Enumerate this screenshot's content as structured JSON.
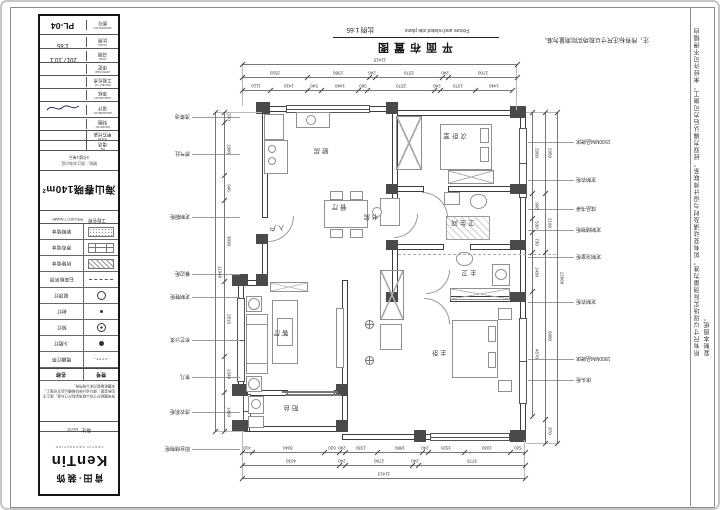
{
  "sheet": {
    "top_note": "注，所有标注尺寸以现场实际测量为准。",
    "edge_note": "所有尺寸以现场实际测量为准，如有变动请及时与设计师联系，经双方确认后方可施工。未经许可不得擅自复制本图纸。",
    "title": {
      "zh": "平面布置图",
      "en": "Fixture and related site plans",
      "scale": "比例 1:65"
    }
  },
  "title_block": {
    "fields": [
      {
        "value": "PL-04",
        "zh": "图号",
        "en": "DRAWING NO"
      },
      {
        "value": "1:65",
        "zh": "比例",
        "en": "SCALE"
      },
      {
        "value": "2017.10.1",
        "zh": "日期",
        "en": "DATE"
      },
      {
        "value": "",
        "zh": "审定",
        "en": "APPROVED"
      },
      {
        "value": "",
        "zh": "工程负责",
        "en": "PROJECT M."
      },
      {
        "value": "",
        "zh": "审核",
        "en": "CHECKED BY"
      },
      {
        "value": "sig",
        "zh": "设计",
        "en": "DESIGNED BY"
      },
      {
        "value": "",
        "zh": "制图",
        "en": "DRAWN BY"
      },
      {
        "value": "",
        "zh": "甲方代表",
        "en": "CLIENT"
      },
      {
        "value": "",
        "zh": "电话",
        "en": "TEL"
      }
    ],
    "address_lines": [
      "地址：剑江半岛小区",
      "3号楼1单元"
    ],
    "project": {
      "value": "海山春晓140m²",
      "zh": "工程名称",
      "en": "PROJECT NAME"
    },
    "legend": {
      "name_header": "名称",
      "symbol_header": "符号",
      "rows": [
        {
          "name": "新砌墙体",
          "sym": "dotted"
        },
        {
          "name": "原有墙体",
          "sym": "brick"
        },
        {
          "name": "拆除墙体",
          "sym": "hatch"
        },
        {
          "name": "石膏板吊顶",
          "sym": "dashed"
        },
        {
          "name": "吸顶灯",
          "sym": "ring"
        },
        {
          "name": "射灯",
          "sym": "dot"
        },
        {
          "name": "筒灯",
          "sym": "target"
        },
        {
          "name": "斗胆灯",
          "sym": "disc"
        },
        {
          "name": "暗藏灯带",
          "sym": "strip"
        }
      ]
    },
    "note": {
      "zh": "备注",
      "en": "NOTE",
      "text": "所有图纸尺寸均以现场实际尺寸为准，施工中如有变更，请与设计师协商确认后方可施工，本图纸版权归本公司所有。"
    },
    "brand": {
      "logo": "KenTin",
      "cn": "肯田·装饰",
      "sub": "KENTIN DECORATION"
    }
  },
  "plan": {
    "rooms": [
      "厨房",
      "餐厅",
      "入户",
      "客厅",
      "阳台",
      "书房",
      "次卧室",
      "卫生间",
      "主卫",
      "主卧"
    ],
    "callouts_left": [
      "洗菜池",
      "燃气灶",
      "定制橱柜",
      "餐边柜",
      "定制鞋柜",
      "布艺沙发",
      "茶几",
      "洗衣机柜",
      "阳台储物柜"
    ],
    "callouts_right": [
      "1500MM品牌床",
      "定制衣柜",
      "成品书桌",
      "定制储物柜",
      "定制浴室柜",
      "定制衣柜",
      "1800MM品牌床",
      "床头柜"
    ],
    "dims": {
      "top_total": [
        "11415"
      ],
      "top_mid": [
        "2520",
        "2380",
        "240",
        "2570",
        "240",
        "2700"
      ],
      "top_inner": [
        "1110",
        "1410",
        "540",
        "1440",
        "360",
        "2570",
        "240",
        "1370",
        "1440"
      ],
      "bottom_inner": [
        "410",
        "3040",
        "620",
        "240",
        "1330",
        "1880",
        "240",
        "1520",
        "1930",
        "520"
      ],
      "bottom_mid": [
        "4030",
        "240",
        "2790",
        "240",
        "3775"
      ],
      "bottom_total": [
        "11413"
      ],
      "right_inner": [
        "2950",
        "908",
        "530",
        "730",
        "1430",
        "4570"
      ],
      "right_mid": [
        "2950",
        "2160",
        "6080",
        "870"
      ],
      "right_total": [
        "12060"
      ],
      "left_inner": [
        "370",
        "1980",
        "945",
        "3030",
        "2810",
        "1340",
        "1460"
      ],
      "left_total": [
        "11940"
      ]
    }
  }
}
